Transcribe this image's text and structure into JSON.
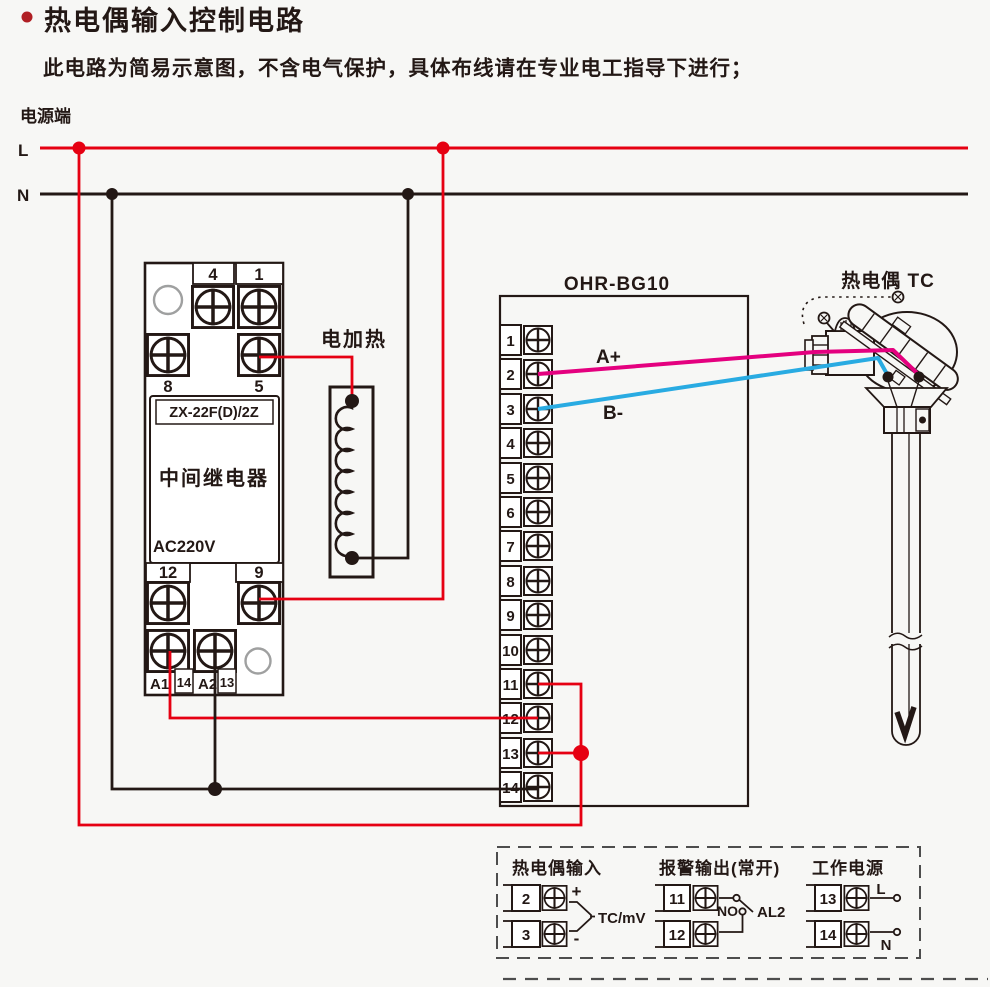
{
  "colors": {
    "red": "#e60012",
    "magenta": "#e4007f",
    "blue": "#29abe2",
    "ink": "#231815",
    "gray": "#9fa0a0",
    "background": "#f7f7f5"
  },
  "header": {
    "title": "热电偶输入控制电路",
    "subtitle": "此电路为简易示意图，不含电气保护，具体布线请在专业电工指导下进行；"
  },
  "power": {
    "label": "电源端",
    "line_l": "L",
    "line_n": "N"
  },
  "relay": {
    "model": "ZX-22F(D)/2Z",
    "name": "中间继电器",
    "voltage": "AC220V",
    "terminals": {
      "t4": "4",
      "t1": "1",
      "t8": "8",
      "t5": "5",
      "t12": "12",
      "t9": "9",
      "a1": "A1",
      "t14": "14",
      "a2": "A2",
      "t13": "13"
    }
  },
  "heater": {
    "label": "电加热"
  },
  "controller": {
    "model": "OHR-BG10",
    "wire_a": "A+",
    "wire_b": "B-",
    "terminals": [
      "1",
      "2",
      "3",
      "4",
      "5",
      "6",
      "7",
      "8",
      "9",
      "10",
      "11",
      "12",
      "13",
      "14"
    ]
  },
  "thermocouple": {
    "label": "热电偶 TC"
  },
  "legend": {
    "tc_input": {
      "title": "热电偶输入",
      "t2": "2",
      "t3": "3",
      "plus": "+",
      "minus": "-",
      "signal": "TC/mV"
    },
    "alarm": {
      "title": "报警输出(常开)",
      "t11": "11",
      "t12": "12",
      "no": "NO",
      "name": "AL2"
    },
    "supply": {
      "title": "工作电源",
      "t13": "13",
      "t14": "14",
      "l": "L",
      "n": "N"
    }
  }
}
